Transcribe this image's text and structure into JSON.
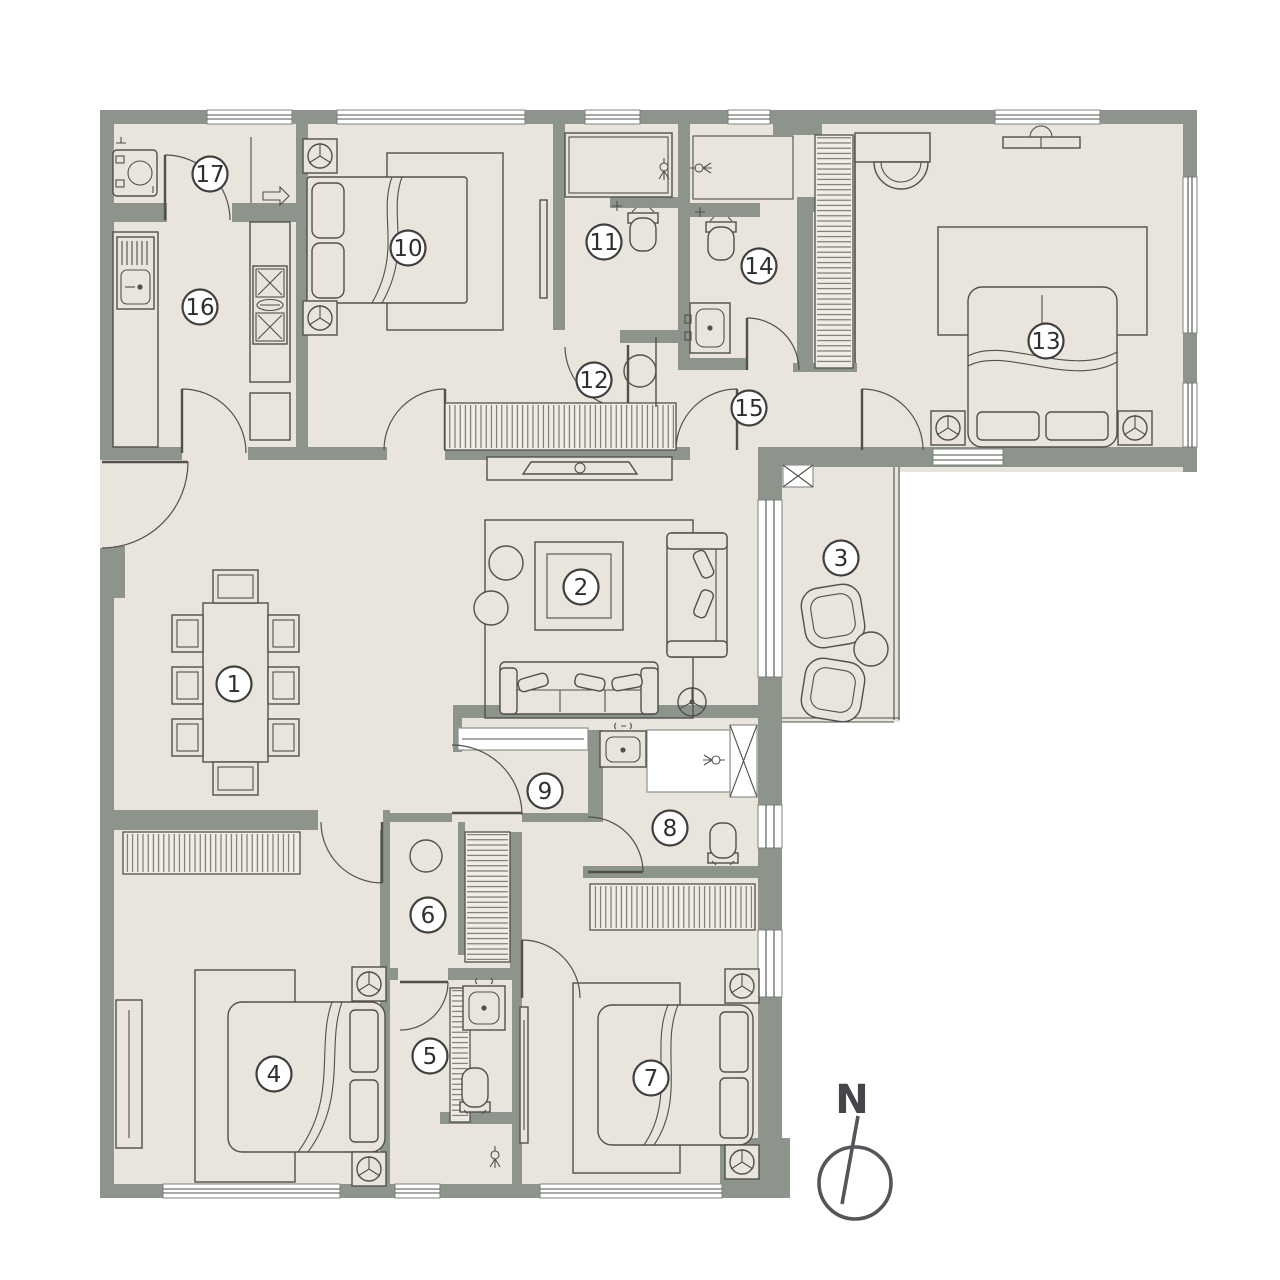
{
  "title": "Apartment floor plan",
  "compass": {
    "label": "N"
  },
  "colors": {
    "wall": "#8c948c",
    "floor": "#e9e4dc",
    "line": "#50504c",
    "background": "#ffffff"
  },
  "rooms": [
    {
      "number": "1",
      "x": 234,
      "y": 684
    },
    {
      "number": "2",
      "x": 581,
      "y": 587
    },
    {
      "number": "3",
      "x": 841,
      "y": 558
    },
    {
      "number": "4",
      "x": 274,
      "y": 1074
    },
    {
      "number": "5",
      "x": 430,
      "y": 1056
    },
    {
      "number": "6",
      "x": 428,
      "y": 915
    },
    {
      "number": "7",
      "x": 651,
      "y": 1078
    },
    {
      "number": "8",
      "x": 670,
      "y": 828
    },
    {
      "number": "9",
      "x": 545,
      "y": 791
    },
    {
      "number": "10",
      "x": 408,
      "y": 248
    },
    {
      "number": "11",
      "x": 604,
      "y": 242
    },
    {
      "number": "12",
      "x": 594,
      "y": 380
    },
    {
      "number": "13",
      "x": 1046,
      "y": 341
    },
    {
      "number": "14",
      "x": 759,
      "y": 266
    },
    {
      "number": "15",
      "x": 749,
      "y": 408
    },
    {
      "number": "16",
      "x": 200,
      "y": 307
    },
    {
      "number": "17",
      "x": 210,
      "y": 174
    }
  ]
}
